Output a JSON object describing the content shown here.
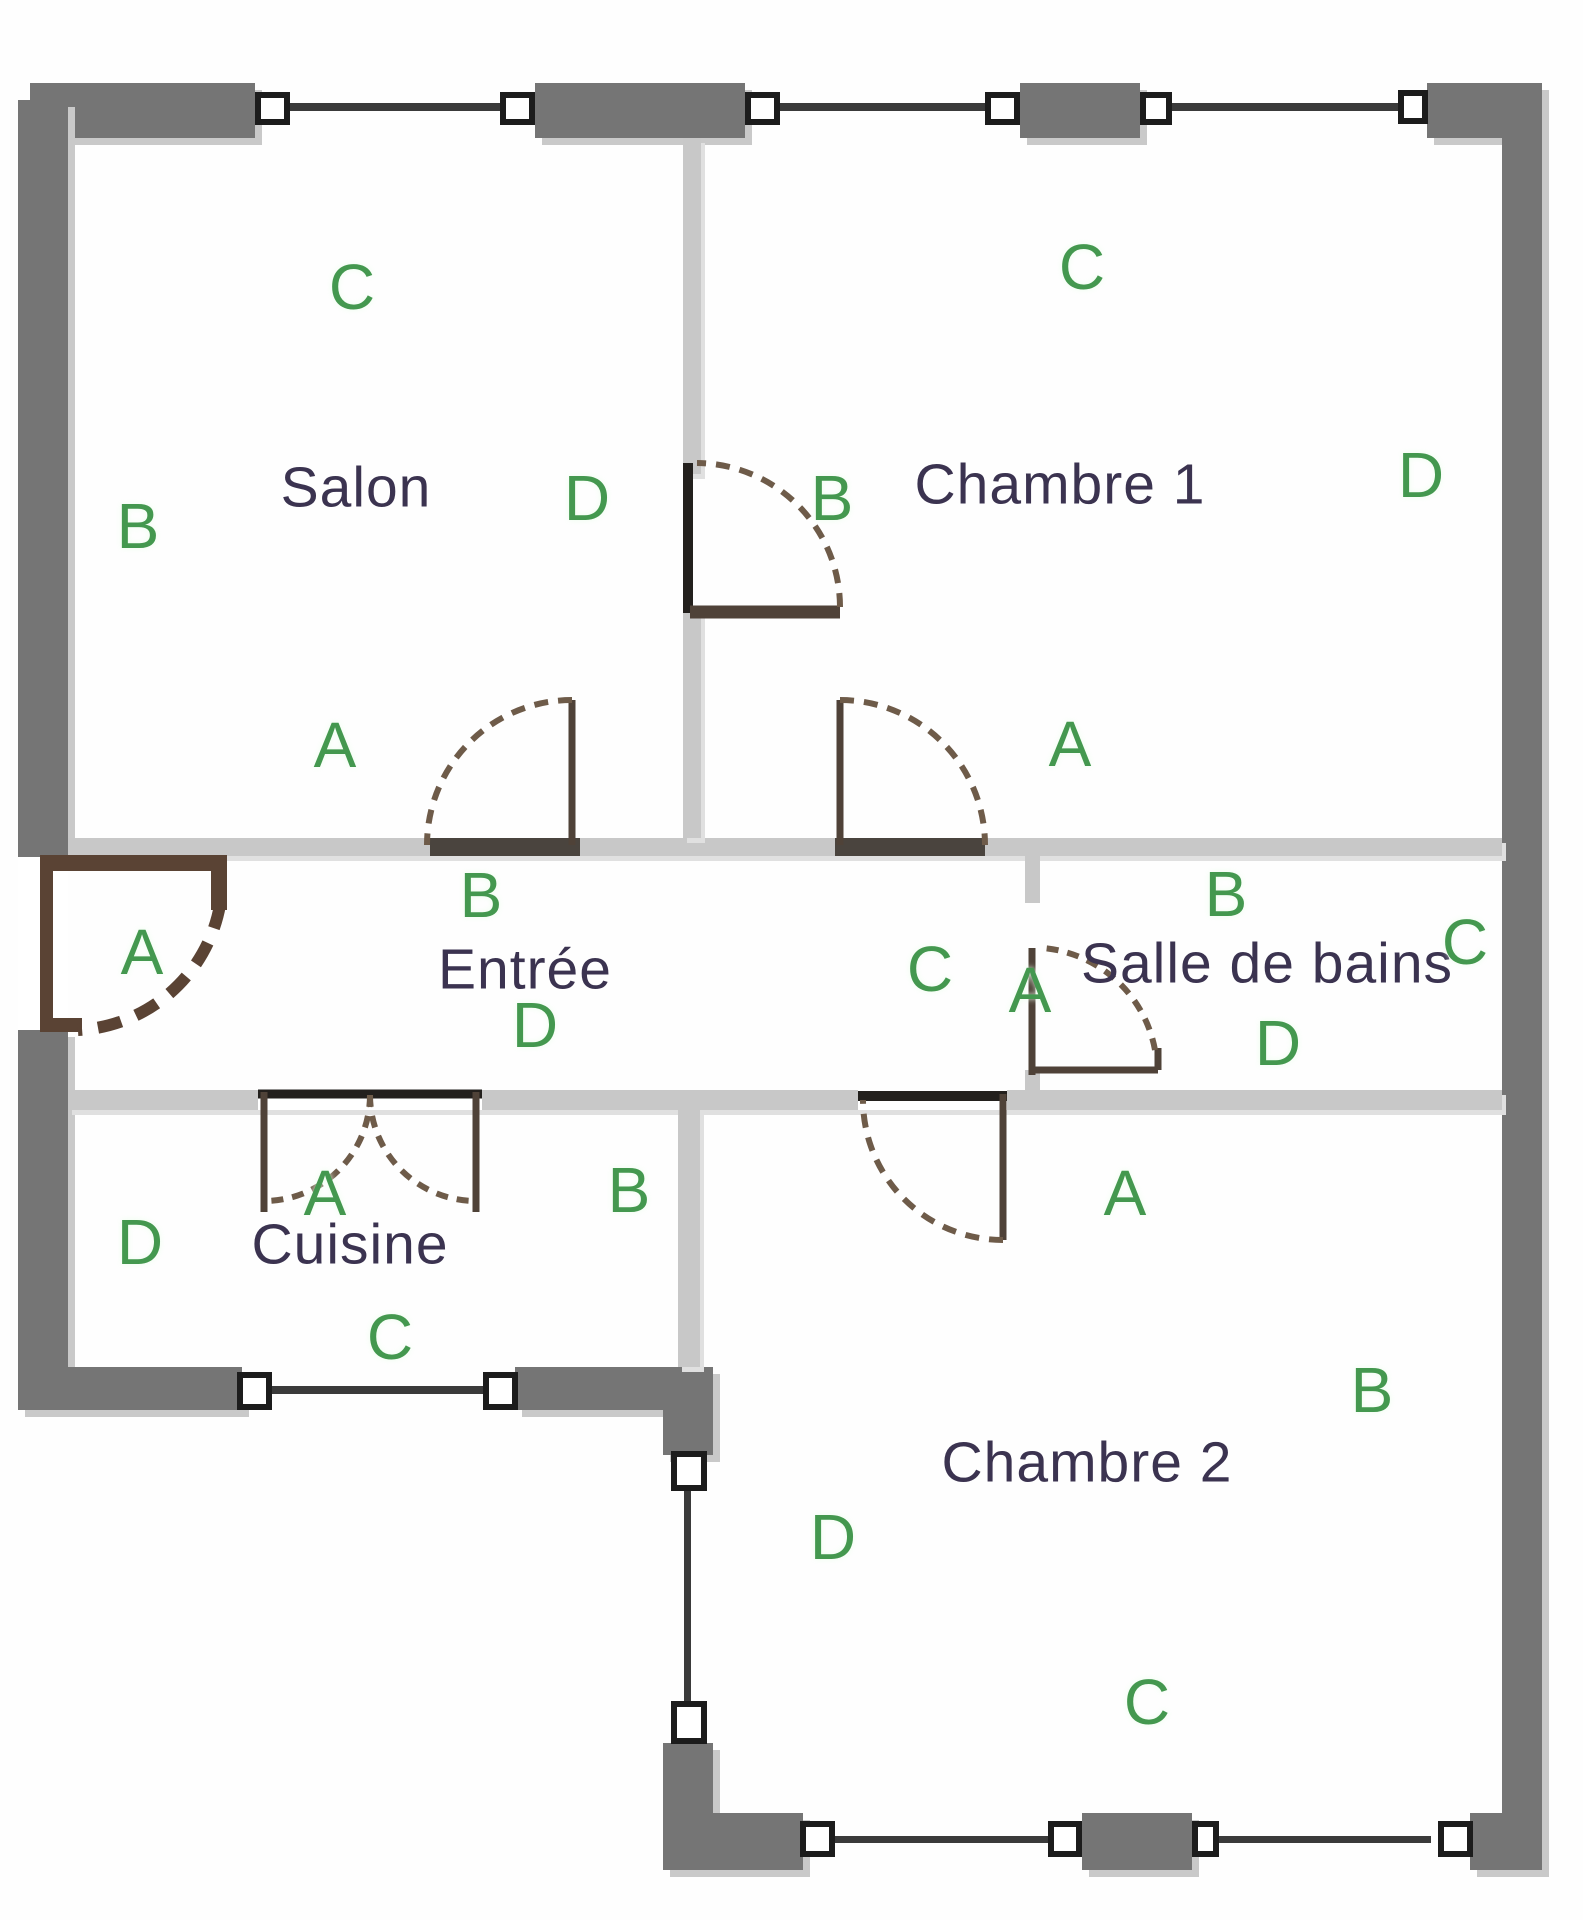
{
  "plan": {
    "title": "Plan d'appartement",
    "colors": {
      "outer": "#757575",
      "inner": "#c8c8c8",
      "threshold": "#4a443e",
      "windowFill": "#ffffff",
      "windowBorder": "#1c1c1c",
      "windowLine": "#3a3a3a",
      "door": "#4f4238",
      "doorDark": "#23201d",
      "doorDash": "#6e5b49",
      "frontDoor": "#5a4334",
      "letter": "#44984f",
      "room": "#3b3350",
      "bg": "#fefefe"
    },
    "rects": [
      {
        "n": "top-wall-segment-1",
        "x": 30,
        "y": 83,
        "w": 225,
        "h": 55,
        "c": "outer",
        "cls": "sh"
      },
      {
        "n": "top-wall-segment-2",
        "x": 535,
        "y": 83,
        "w": 210,
        "h": 55,
        "c": "outer",
        "cls": "sh"
      },
      {
        "n": "top-wall-segment-3",
        "x": 1020,
        "y": 83,
        "w": 120,
        "h": 55,
        "c": "outer",
        "cls": "sh"
      },
      {
        "n": "top-wall-segment-4",
        "x": 1427,
        "y": 83,
        "w": 113,
        "h": 55,
        "c": "outer",
        "cls": "sh"
      },
      {
        "n": "left-wall-upper",
        "x": 18,
        "y": 100,
        "w": 50,
        "h": 757,
        "c": "outer",
        "cls": "sh"
      },
      {
        "n": "left-wall-lower",
        "x": 18,
        "y": 1030,
        "w": 50,
        "h": 380,
        "c": "outer",
        "cls": "sh"
      },
      {
        "n": "right-wall",
        "x": 1502,
        "y": 83,
        "w": 40,
        "h": 1787,
        "c": "outer",
        "cls": "sh"
      },
      {
        "n": "kitchen-bottom-wall-1",
        "x": 22,
        "y": 1367,
        "w": 220,
        "h": 43,
        "c": "outer",
        "cls": "sh"
      },
      {
        "n": "kitchen-bottom-wall-2",
        "x": 515,
        "y": 1367,
        "w": 153,
        "h": 43,
        "c": "outer",
        "cls": "sh"
      },
      {
        "n": "kitchen-corner-post",
        "x": 663,
        "y": 1367,
        "w": 50,
        "h": 88,
        "c": "outer",
        "cls": "sh"
      },
      {
        "n": "bedroom2-left-wall-lower",
        "x": 663,
        "y": 1743,
        "w": 50,
        "h": 78,
        "c": "outer",
        "cls": "sh"
      },
      {
        "n": "bottom-wall-segment-1",
        "x": 663,
        "y": 1813,
        "w": 140,
        "h": 57,
        "c": "outer",
        "cls": "sh"
      },
      {
        "n": "bottom-wall-segment-2",
        "x": 1082,
        "y": 1813,
        "w": 110,
        "h": 57,
        "c": "outer",
        "cls": "sh"
      },
      {
        "n": "bottom-wall-segment-3",
        "x": 1470,
        "y": 1813,
        "w": 72,
        "h": 57,
        "c": "outer",
        "cls": "sh"
      },
      {
        "n": "corridor-top-wall",
        "x": 68,
        "y": 838,
        "w": 1434,
        "h": 18,
        "c": "inner",
        "cls": "ish"
      },
      {
        "n": "corridor-bottom-wall",
        "x": 68,
        "y": 1090,
        "w": 1434,
        "h": 20,
        "c": "inner",
        "cls": "ish"
      },
      {
        "n": "salon-bedroom1-divider-upper",
        "x": 683,
        "y": 138,
        "w": 18,
        "h": 336,
        "c": "inner",
        "cls": "ish"
      },
      {
        "n": "salon-bedroom1-divider-lower",
        "x": 683,
        "y": 612,
        "w": 18,
        "h": 226,
        "c": "inner",
        "cls": "ish"
      },
      {
        "n": "bathroom-wall-upper",
        "x": 1025,
        "y": 856,
        "w": 15,
        "h": 47,
        "c": "inner"
      },
      {
        "n": "bathroom-wall-lower",
        "x": 1025,
        "y": 1070,
        "w": 15,
        "h": 25,
        "c": "inner"
      },
      {
        "n": "kitchen-right-wall",
        "x": 678,
        "y": 1110,
        "w": 22,
        "h": 257,
        "c": "inner",
        "cls": "ish"
      },
      {
        "n": "salon-door-sill",
        "x": 430,
        "y": 838,
        "w": 150,
        "h": 18,
        "c": "threshold"
      },
      {
        "n": "bedroom1-door-sill",
        "x": 835,
        "y": 838,
        "w": 150,
        "h": 18,
        "c": "threshold"
      },
      {
        "n": "kitchen-door-opening",
        "x": 258,
        "y": 1090,
        "w": 224,
        "h": 20,
        "c": "windowFill"
      },
      {
        "n": "bedroom2-door-opening",
        "x": 858,
        "y": 1090,
        "w": 149,
        "h": 20,
        "c": "windowFill"
      },
      {
        "n": "entry-door-opening",
        "x": 18,
        "y": 857,
        "w": 50,
        "h": 173,
        "c": "windowFill"
      },
      {
        "n": "entry-door-leaf",
        "x": 43,
        "y": 855,
        "w": 184,
        "h": 16,
        "c": "frontDoor"
      },
      {
        "n": "entry-door-stub",
        "x": 211,
        "y": 868,
        "w": 16,
        "h": 42,
        "c": "frontDoor"
      },
      {
        "n": "entry-door-jamb",
        "x": 40,
        "y": 855,
        "w": 13,
        "h": 177,
        "c": "frontDoor"
      },
      {
        "n": "entry-door-foot",
        "x": 40,
        "y": 1018,
        "w": 42,
        "h": 14,
        "c": "frontDoor"
      }
    ],
    "windows": [
      {
        "n": "window-top-1a",
        "x": 255,
        "y": 92,
        "w": 35,
        "h": 33
      },
      {
        "n": "window-top-1b",
        "x": 500,
        "y": 92,
        "w": 35,
        "h": 33
      },
      {
        "n": "window-top-2a",
        "x": 745,
        "y": 92,
        "w": 35,
        "h": 33
      },
      {
        "n": "window-top-2b",
        "x": 985,
        "y": 92,
        "w": 35,
        "h": 33
      },
      {
        "n": "window-top-3a",
        "x": 1140,
        "y": 92,
        "w": 32,
        "h": 33
      },
      {
        "n": "window-top-3b",
        "x": 1398,
        "y": 90,
        "w": 30,
        "h": 34
      },
      {
        "n": "window-kitchen-a",
        "x": 237,
        "y": 1372,
        "w": 35,
        "h": 38
      },
      {
        "n": "window-kitchen-b",
        "x": 483,
        "y": 1372,
        "w": 35,
        "h": 38
      },
      {
        "n": "window-bedroom2-left-a",
        "x": 671,
        "y": 1451,
        "w": 36,
        "h": 40
      },
      {
        "n": "window-bedroom2-left-b",
        "x": 671,
        "y": 1701,
        "w": 36,
        "h": 43
      },
      {
        "n": "window-bottom-1a",
        "x": 800,
        "y": 1821,
        "w": 35,
        "h": 36
      },
      {
        "n": "window-bottom-1b",
        "x": 1048,
        "y": 1821,
        "w": 34,
        "h": 36
      },
      {
        "n": "window-bottom-2a",
        "x": 1192,
        "y": 1821,
        "w": 27,
        "h": 36
      },
      {
        "n": "window-bottom-2b",
        "x": 1438,
        "y": 1821,
        "w": 35,
        "h": 36
      }
    ],
    "window_lines": [
      {
        "n": "window-glass-top-1",
        "x": 290,
        "y": 103,
        "w": 210,
        "h": 8
      },
      {
        "n": "window-glass-top-2",
        "x": 780,
        "y": 103,
        "w": 205,
        "h": 8
      },
      {
        "n": "window-glass-top-3",
        "x": 1172,
        "y": 103,
        "w": 226,
        "h": 8
      },
      {
        "n": "window-glass-kitchen",
        "x": 272,
        "y": 1386,
        "w": 211,
        "h": 8
      },
      {
        "n": "window-glass-bedroom2-left",
        "x": 684,
        "y": 1491,
        "w": 7,
        "h": 210
      },
      {
        "n": "window-glass-bottom-1",
        "x": 835,
        "y": 1836,
        "w": 213,
        "h": 7
      },
      {
        "n": "window-glass-bottom-2",
        "x": 1219,
        "y": 1836,
        "w": 212,
        "h": 7
      }
    ],
    "paths": [
      {
        "n": "salon-door-leaf",
        "d": "M572,700 L572,845",
        "c": "door",
        "w": 7
      },
      {
        "n": "salon-door-arc",
        "d": "M572,700 A145,145 0 0 0 427,845",
        "c": "doorDash",
        "w": 6,
        "dash": "14 10"
      },
      {
        "n": "bedroom1-door-leaf",
        "d": "M840,700 L840,845",
        "c": "door",
        "w": 7
      },
      {
        "n": "bedroom1-door-arc",
        "d": "M840,700 A145,145 0 0 1 985,845",
        "c": "doorDash",
        "w": 6,
        "dash": "14 10"
      },
      {
        "n": "divider-door-jamb",
        "d": "M688,463 L688,613",
        "c": "doorDark",
        "w": 10
      },
      {
        "n": "divider-door-leaf",
        "d": "M690,612 L840,612",
        "c": "door",
        "w": 13
      },
      {
        "n": "divider-door-arc",
        "d": "M840,607 A144,144 0 0 0 697,463",
        "c": "doorDash",
        "w": 6,
        "dash": "14 10"
      },
      {
        "n": "kitchen-door-header",
        "d": "M258,1094 L482,1094",
        "c": "doorDark",
        "w": 9
      },
      {
        "n": "kitchen-door-leaf-left",
        "d": "M264,1092 L264,1212",
        "c": "door",
        "w": 7
      },
      {
        "n": "kitchen-door-leaf-right",
        "d": "M476,1092 L476,1212",
        "c": "door",
        "w": 7
      },
      {
        "n": "kitchen-door-arc-left",
        "d": "M370,1095 A106,106 0 0 1 264,1201",
        "c": "doorDash",
        "w": 6,
        "dash": "12 9"
      },
      {
        "n": "kitchen-door-arc-right",
        "d": "M370,1095 A106,106 0 0 0 476,1201",
        "c": "doorDash",
        "w": 6,
        "dash": "12 9"
      },
      {
        "n": "bedroom2-door-header",
        "d": "M858,1096 L1007,1096",
        "c": "doorDark",
        "w": 10
      },
      {
        "n": "bedroom2-door-leaf",
        "d": "M1003,1094 L1003,1240",
        "c": "door",
        "w": 7
      },
      {
        "n": "bedroom2-door-arc",
        "d": "M1003,1240 A140,140 0 0 1 863,1100",
        "c": "doorDash",
        "w": 6,
        "dash": "14 10"
      },
      {
        "n": "bathroom-door-jamb",
        "d": "M1032,948 L1032,1075",
        "c": "door",
        "w": 7
      },
      {
        "n": "bathroom-door-leaf",
        "d": "M1035,1070 L1158,1070",
        "c": "door",
        "w": 7
      },
      {
        "n": "bathroom-door-stub",
        "d": "M1158,1048 L1158,1070",
        "c": "door",
        "w": 7
      },
      {
        "n": "bathroom-door-arc",
        "d": "M1155,1050 A125,125 0 0 0 1043,948",
        "c": "doorDash",
        "w": 6,
        "dash": "12 9"
      },
      {
        "n": "entry-door-arc",
        "d": "M220,905 A152,152 0 0 1 78,1030",
        "c": "frontDoor",
        "w": 12,
        "dash": "24 16"
      }
    ],
    "rooms": [
      {
        "name": "Salon",
        "label": {
          "x": 356,
          "y": 490
        },
        "letters": [
          {
            "t": "C",
            "x": 352,
            "y": 290
          },
          {
            "t": "B",
            "x": 138,
            "y": 529
          },
          {
            "t": "D",
            "x": 587,
            "y": 501
          },
          {
            "t": "A",
            "x": 335,
            "y": 748
          }
        ]
      },
      {
        "name": "Chambre 1",
        "label": {
          "x": 1060,
          "y": 487
        },
        "letters": [
          {
            "t": "C",
            "x": 1082,
            "y": 270
          },
          {
            "t": "B",
            "x": 832,
            "y": 501
          },
          {
            "t": "D",
            "x": 1421,
            "y": 478
          },
          {
            "t": "A",
            "x": 1070,
            "y": 747
          }
        ]
      },
      {
        "name": "Entrée",
        "label": {
          "x": 525,
          "y": 972
        },
        "letters": [
          {
            "t": "A",
            "x": 142,
            "y": 955
          },
          {
            "t": "B",
            "x": 481,
            "y": 898
          },
          {
            "t": "C",
            "x": 930,
            "y": 972
          },
          {
            "t": "D",
            "x": 535,
            "y": 1028
          }
        ]
      },
      {
        "name": "Salle de bains",
        "label": {
          "x": 1267,
          "y": 966
        },
        "letters": [
          {
            "t": "B",
            "x": 1226,
            "y": 897
          },
          {
            "t": "C",
            "x": 1465,
            "y": 945
          },
          {
            "t": "D",
            "x": 1278,
            "y": 1046
          },
          {
            "t": "A",
            "x": 1030,
            "y": 993
          }
        ]
      },
      {
        "name": "Cuisine",
        "label": {
          "x": 350,
          "y": 1247
        },
        "letters": [
          {
            "t": "A",
            "x": 325,
            "y": 1196
          },
          {
            "t": "B",
            "x": 629,
            "y": 1193
          },
          {
            "t": "C",
            "x": 390,
            "y": 1340
          },
          {
            "t": "D",
            "x": 140,
            "y": 1245
          }
        ]
      },
      {
        "name": "Chambre 2",
        "label": {
          "x": 1087,
          "y": 1465
        },
        "letters": [
          {
            "t": "A",
            "x": 1125,
            "y": 1196
          },
          {
            "t": "B",
            "x": 1372,
            "y": 1393
          },
          {
            "t": "C",
            "x": 1147,
            "y": 1705
          },
          {
            "t": "D",
            "x": 833,
            "y": 1540
          }
        ]
      }
    ]
  }
}
